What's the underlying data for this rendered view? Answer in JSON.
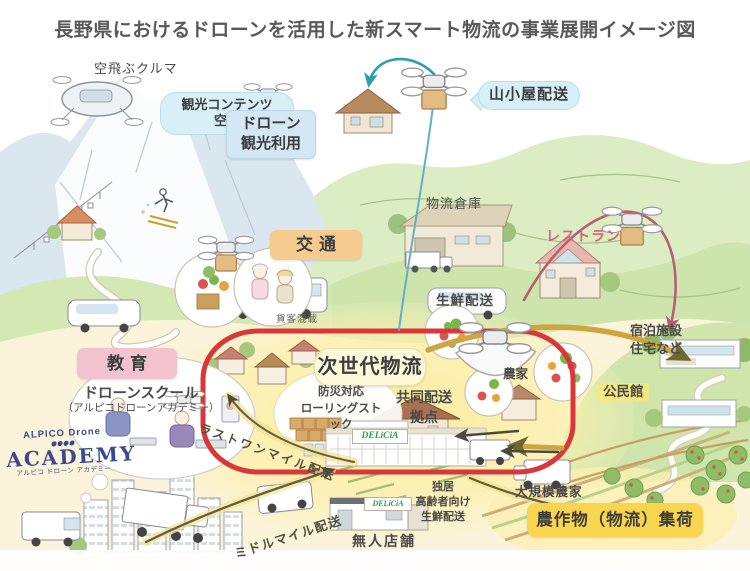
{
  "title": "長野県におけるドローンを活用した新スマート物流の事業展開イメージ図",
  "colors": {
    "red-outline": "#d9383b",
    "highlight-yellow": "#f9d44f",
    "box-orange": "#f6cb8e",
    "box-pink": "#f2c3cf",
    "box-blue": "#d3e7f4",
    "bubble-cyan": "#d7f0f7",
    "box-cream": "#fdf9d9",
    "text-dark": "#4a4a4a",
    "text-pink": "#d9617a",
    "logo-navy": "#3b4a8f",
    "delicia-green": "#2f9e49",
    "arrow-olive": "#cda63e",
    "arrow-teal": "#2f9db0",
    "arrow-pink": "#b65f72"
  },
  "labels": {
    "flying_car": "空飛ぶクルマ",
    "tourism_aerial": "観光コンテンツ\n空撮",
    "drone_tourism": "ドローン\n観光利用",
    "mountain_hut_delivery": "山小屋配送",
    "logistics_warehouse": "物流倉庫",
    "restaurant": "レストラン",
    "transport": "交通",
    "freight_passenger_mix": "貨客混載",
    "fresh_delivery": "生鮮配送",
    "accommodation": "宿泊施設\n住宅など",
    "education": "教育",
    "drone_school": "ドローンスクール",
    "drone_school_sub": "（アルピコドローンアカデミー）",
    "next_gen_logistics": "次世代物流",
    "disaster_stock": "防災対応\nローリングストック",
    "joint_delivery_base": "共同配送\n拠点",
    "delicia_main_sign": "DELiCiA",
    "last_one_mile": "ラストワンマイル配送",
    "middle_mile": "ミドルマイル配送",
    "unmanned_store": "無人店舗",
    "delicia_store_sign": "DELiCiA",
    "elderly_fresh_delivery": "独居\n高齢者向け\n生鮮配送",
    "large_scale_farmer": "大規模農家",
    "crop_collection": "農作物（物流）集荷",
    "community_center": "公民館",
    "farmer": "農家"
  },
  "logo": {
    "line1": "ALPICO Drone",
    "line2": "ACADEMY",
    "line3": "アルピコ ドローン アカデミー"
  }
}
